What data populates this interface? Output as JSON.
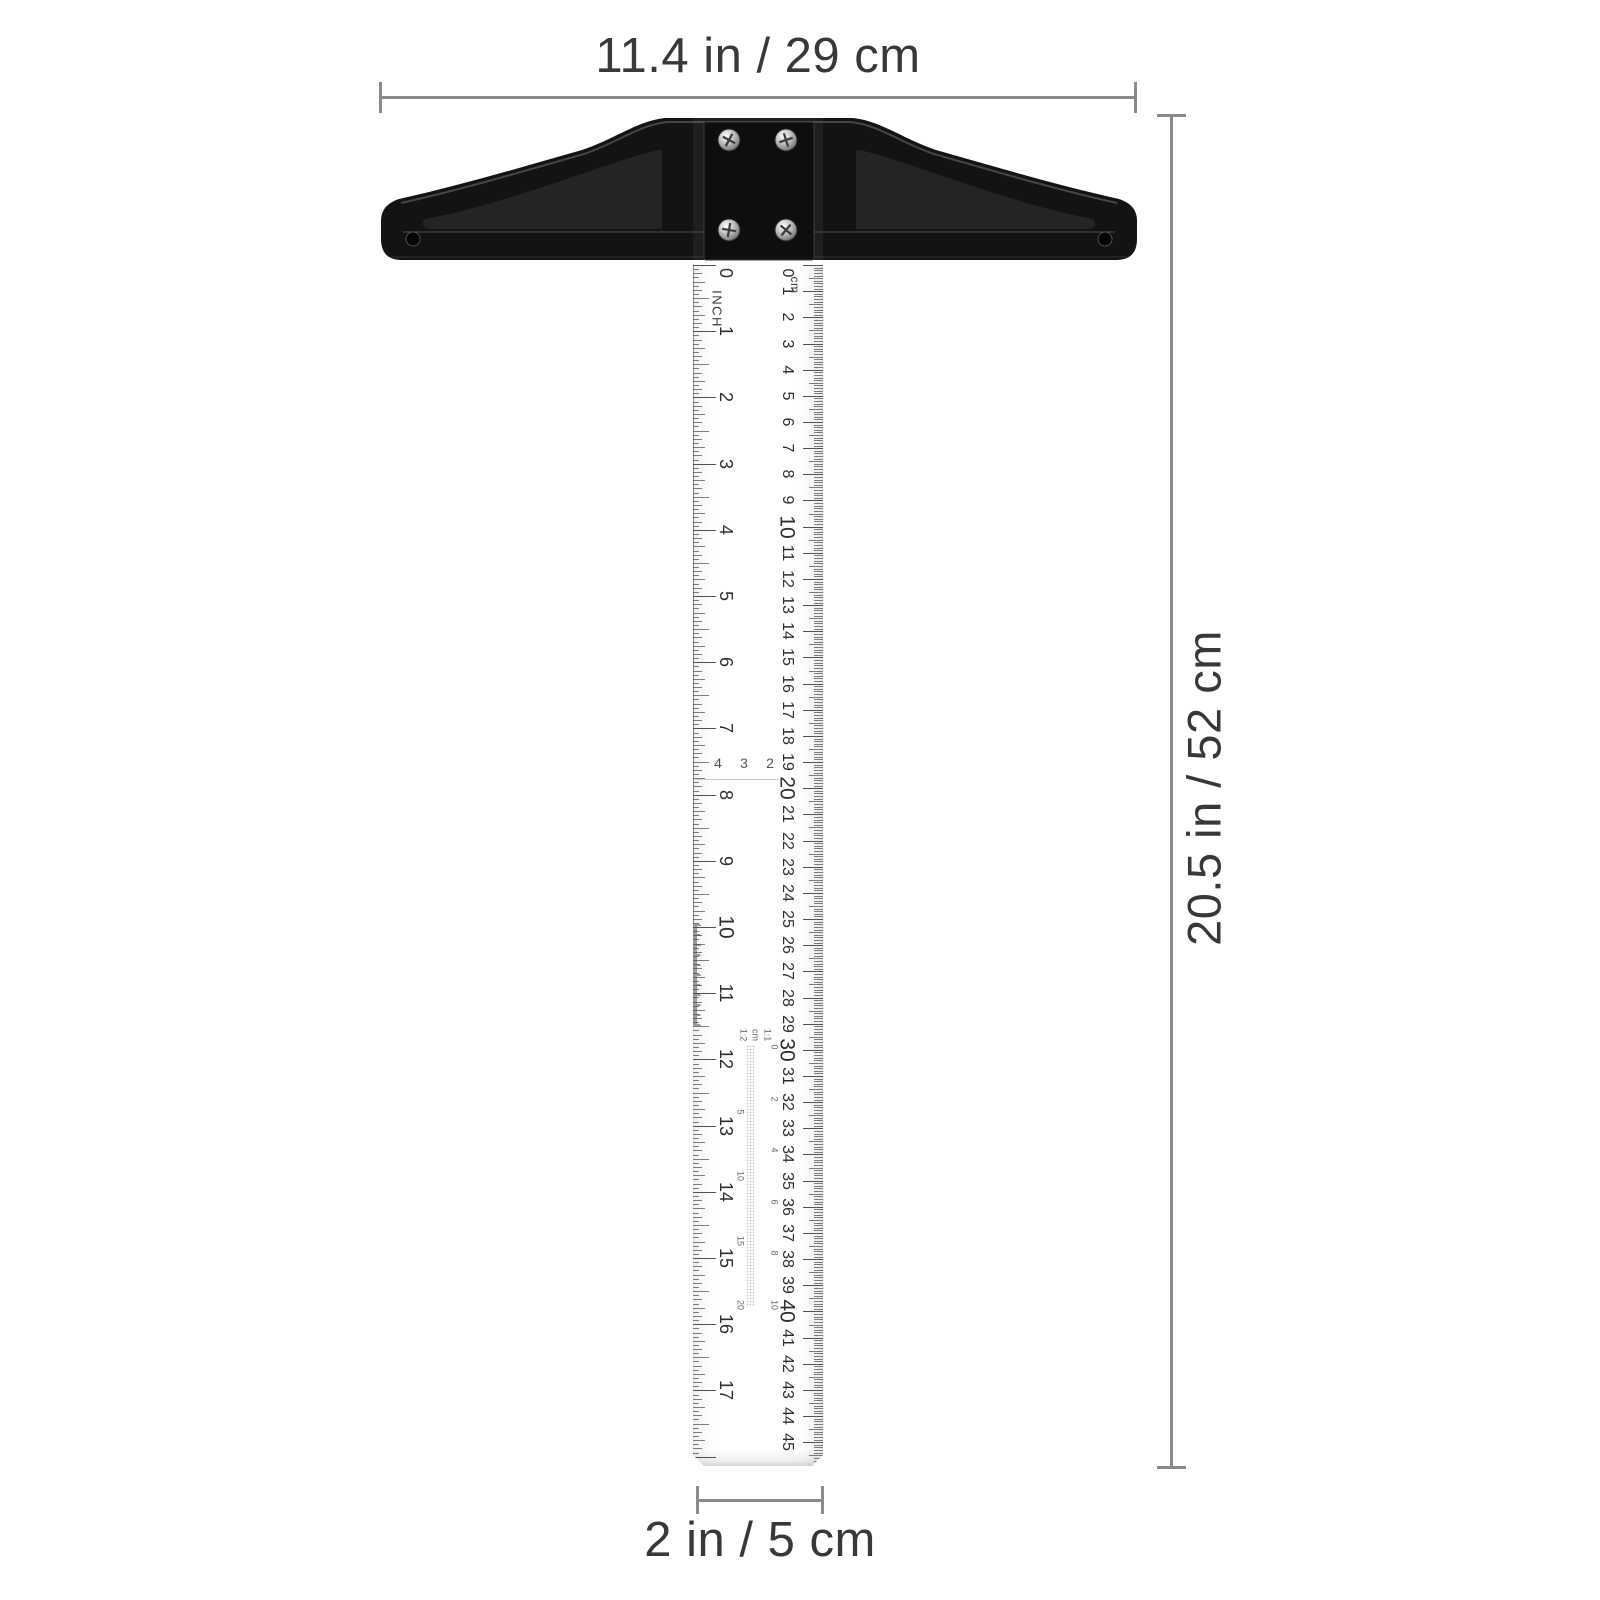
{
  "annotations": {
    "width_label": "11.4 in / 29 cm",
    "height_label": "20.5 in / 52 cm",
    "blade_width_label": "2 in / 5 cm"
  },
  "colors": {
    "background": "#ffffff",
    "dimension_line": "#8a8a8a",
    "dimension_text": "#383838",
    "head": "#131313",
    "tick": "#4a4a4a"
  },
  "head": {
    "screw_count": 4
  },
  "ruler": {
    "inch_scale": {
      "unit_label": "INCH",
      "numbers": [
        0,
        1,
        2,
        3,
        4,
        5,
        6,
        7,
        8,
        9,
        10,
        11,
        12,
        13,
        14,
        15,
        16,
        17
      ]
    },
    "cm_scale": {
      "unit_label": "cm",
      "numbers": [
        0,
        1,
        2,
        3,
        4,
        5,
        6,
        7,
        8,
        9,
        10,
        11,
        12,
        13,
        14,
        15,
        16,
        17,
        18,
        19,
        20,
        21,
        22,
        23,
        24,
        25,
        26,
        27,
        28,
        29,
        30,
        31,
        32,
        33,
        34,
        35,
        36,
        37,
        38,
        39,
        40,
        41,
        42,
        43,
        44,
        45
      ]
    },
    "mid_scale": {
      "numbers": [
        "4",
        "3",
        "2"
      ]
    },
    "half_scale": {
      "top_labels": [
        "1:2",
        "cm",
        "1:1"
      ],
      "left_numbers": [
        "5",
        "10",
        "15",
        "20"
      ],
      "right_numbers": [
        "0",
        "2",
        "4",
        "6",
        "8",
        "10"
      ]
    }
  }
}
